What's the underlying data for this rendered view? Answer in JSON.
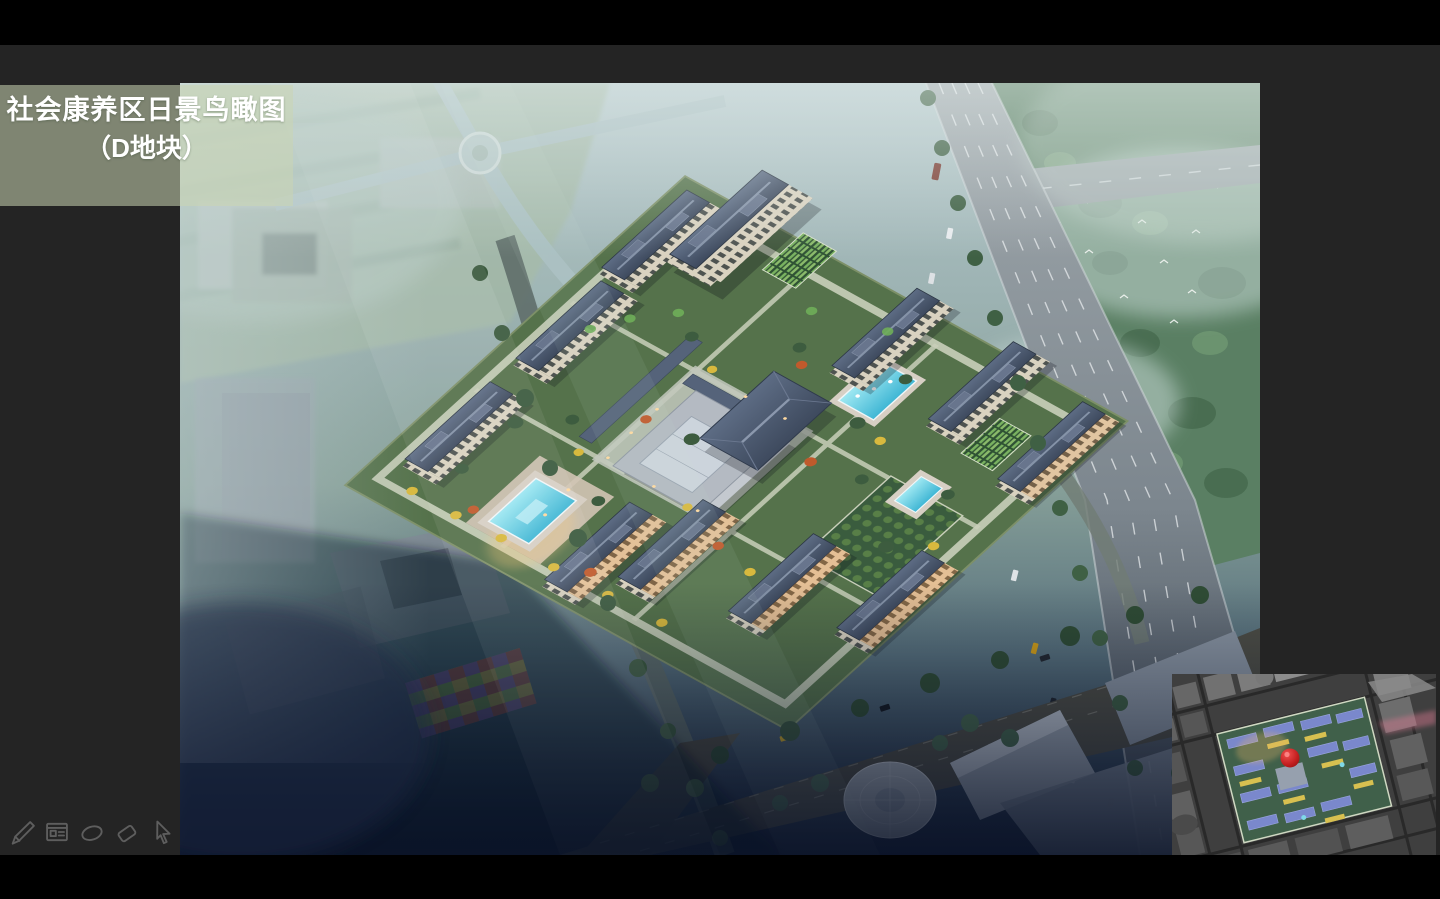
{
  "slide": {
    "title": {
      "line1": "社会康养区日景鸟瞰图",
      "line2": "（D地块）"
    }
  },
  "toolbar": {
    "icons": [
      {
        "name": "pen-icon"
      },
      {
        "name": "slide-panel-icon"
      },
      {
        "name": "ellipse-annotation-icon"
      },
      {
        "name": "eraser-icon"
      },
      {
        "name": "cursor-arrow-icon"
      }
    ]
  },
  "inset_map": {
    "marker_color": "#c41f1f"
  },
  "colors": {
    "frame_black": "#000000",
    "stage_background": "#242424",
    "title_overlay": "rgba(203,213,178,0.55)",
    "title_text": "#ffffff",
    "toolbar_icon": "#5e5e5e",
    "roof_slate": "#46546a",
    "facade_cream": "#d9d2c0",
    "grass_green": "#55724b",
    "pool_cyan": "#5ecbe4",
    "autumn_yellow": "#d8b93e",
    "autumn_orange": "#c05a2c",
    "highway_gray": "#8b949a",
    "dusk_navy": "#16223a",
    "marker_red": "#c41f1f"
  }
}
